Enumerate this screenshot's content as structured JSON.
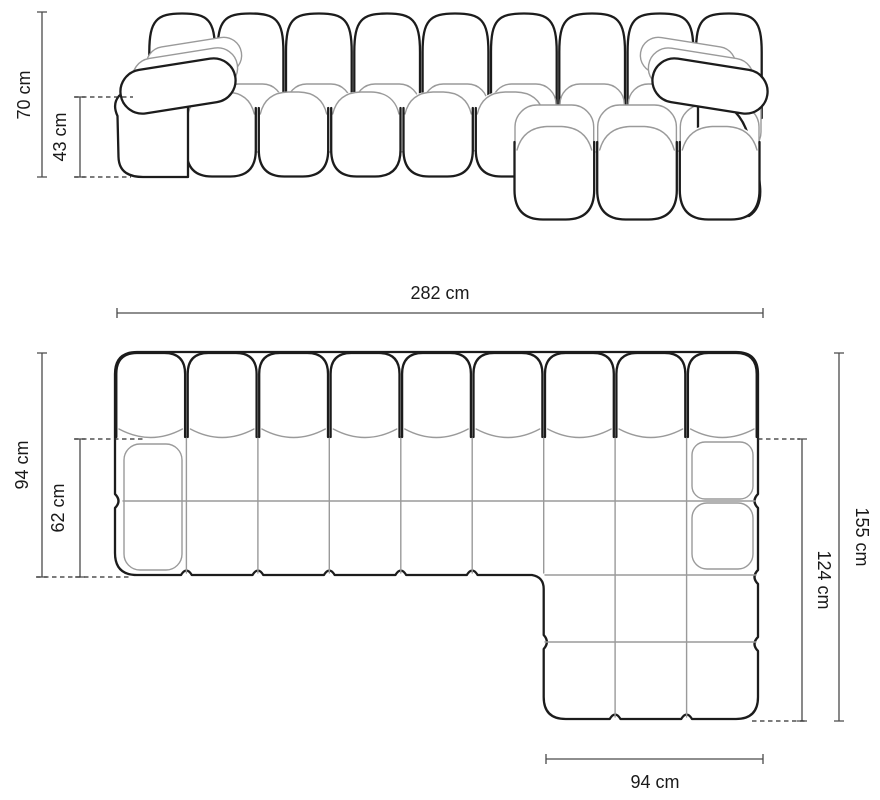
{
  "dimensions": {
    "front_height": "70 cm",
    "front_seat_height": "43 cm",
    "total_width": "282 cm",
    "depth": "94 cm",
    "seat_depth": "62 cm",
    "chaise_total_depth": "155 cm",
    "chaise_extension": "124 cm",
    "chaise_width": "94 cm"
  },
  "colors": {
    "outline": "#1c1c1c",
    "inner_line": "#9a9a9a",
    "dimension_line": "#4a4a4a",
    "dashed_line": "#2e2e2e",
    "label_text": "#1a1a1a",
    "background": "#ffffff"
  }
}
